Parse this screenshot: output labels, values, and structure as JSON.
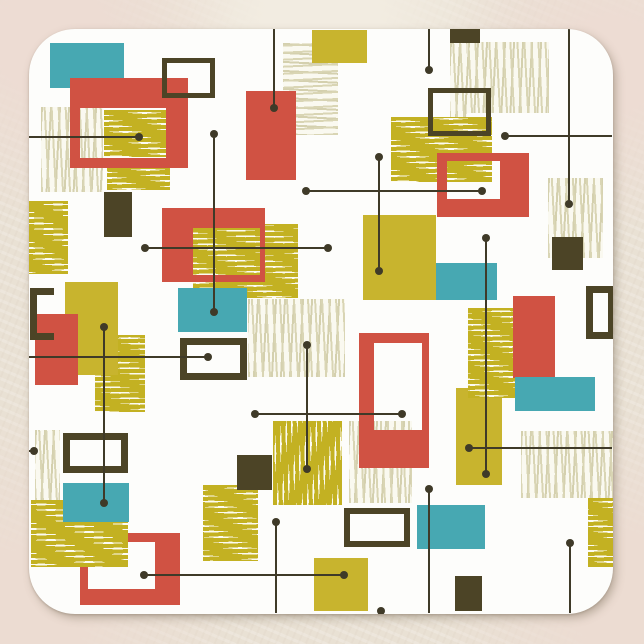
{
  "scene": {
    "description": "mid-century-modern-abstract-rectangles-coaster",
    "canvas": {
      "width": 644,
      "height": 644
    }
  },
  "palette": {
    "red": "#d05243",
    "teal": "#47a8b2",
    "mustard": "#c8b42e",
    "dark": "#4c4426",
    "mustard_line": "#c3b122",
    "pale_line": "#d9d5b4",
    "hatch_bg": "#fcfbf2",
    "line": "#3f3a28",
    "coaster_white": "#fdfdfb",
    "background_beige": "#e9e1d4"
  },
  "coaster": {
    "x": 29,
    "y": 29,
    "w": 584,
    "h": 585,
    "radius": 46
  },
  "shapes": [
    {
      "name": "pale-hatch-upper-left",
      "kind": "hatch",
      "dir": "v",
      "tone": "pale",
      "x": 41,
      "y": 107,
      "w": 62,
      "h": 85
    },
    {
      "name": "mustard-hatch-left",
      "kind": "hatch",
      "dir": "h",
      "tone": "mustard",
      "x": 29,
      "y": 201,
      "w": 39,
      "h": 73
    },
    {
      "name": "mustard-hatch-below-frame1",
      "kind": "hatch",
      "dir": "h",
      "tone": "mustard",
      "x": 107,
      "y": 167,
      "w": 63,
      "h": 23
    },
    {
      "name": "mustard-hatch-left-mid",
      "kind": "hatch",
      "dir": "h",
      "tone": "mustard",
      "x": 95,
      "y": 335,
      "w": 50,
      "h": 77
    },
    {
      "name": "pale-hatch-top-center",
      "kind": "hatch",
      "dir": "h",
      "tone": "pale",
      "x": 283,
      "y": 43,
      "w": 55,
      "h": 92
    },
    {
      "name": "pale-hatch-top-right",
      "kind": "hatch",
      "dir": "v",
      "tone": "pale",
      "x": 450,
      "y": 42,
      "w": 99,
      "h": 71
    },
    {
      "name": "pale-hatch-top-right-column",
      "kind": "hatch",
      "dir": "v",
      "tone": "pale",
      "x": 450,
      "y": 42,
      "w": 17,
      "h": 93
    },
    {
      "name": "mustard-hatch-upper-right",
      "kind": "hatch",
      "dir": "h",
      "tone": "mustard",
      "x": 391,
      "y": 117,
      "w": 101,
      "h": 65
    },
    {
      "name": "pale-hatch-right",
      "kind": "hatch",
      "dir": "v",
      "tone": "pale",
      "x": 548,
      "y": 178,
      "w": 55,
      "h": 80
    },
    {
      "name": "mustard-hatch-under-red-center",
      "kind": "hatch",
      "dir": "h",
      "tone": "mustard",
      "x": 193,
      "y": 224,
      "w": 105,
      "h": 74
    },
    {
      "name": "pale-hatch-center",
      "kind": "hatch",
      "dir": "v",
      "tone": "pale",
      "x": 248,
      "y": 299,
      "w": 97,
      "h": 78
    },
    {
      "name": "pale-hatch-left-edge",
      "kind": "hatch",
      "dir": "v",
      "tone": "pale",
      "x": 35,
      "y": 430,
      "w": 25,
      "h": 73
    },
    {
      "name": "mustard-hatch-center-low",
      "kind": "hatch",
      "dir": "h",
      "tone": "mustard",
      "x": 203,
      "y": 485,
      "w": 55,
      "h": 76
    },
    {
      "name": "mustard-hatch-mid-right",
      "kind": "hatch",
      "dir": "v",
      "tone": "mustard",
      "x": 273,
      "y": 421,
      "w": 69,
      "h": 84
    },
    {
      "name": "pale-hatch-behind-red-frame3",
      "kind": "hatch",
      "dir": "v",
      "tone": "pale",
      "x": 349,
      "y": 421,
      "w": 63,
      "h": 82
    },
    {
      "name": "pale-hatch-bottom-right",
      "kind": "hatch",
      "dir": "v",
      "tone": "pale",
      "x": 521,
      "y": 431,
      "w": 92,
      "h": 67
    },
    {
      "name": "mustard-hatch-right-edge",
      "kind": "hatch",
      "dir": "h",
      "tone": "mustard",
      "x": 588,
      "y": 498,
      "w": 25,
      "h": 69
    },
    {
      "name": "teal-rect-top-left",
      "kind": "solid",
      "color": "teal",
      "x": 50,
      "y": 43,
      "w": 74,
      "h": 45
    },
    {
      "name": "mustard-rect-top",
      "kind": "solid",
      "color": "mustard",
      "x": 312,
      "y": 30,
      "w": 55,
      "h": 33
    },
    {
      "name": "dark-rect-top",
      "kind": "solid",
      "color": "dark",
      "x": 450,
      "y": 29,
      "w": 30,
      "h": 14
    },
    {
      "name": "red-rect-upper-right",
      "kind": "solid",
      "color": "red",
      "x": 246,
      "y": 91,
      "w": 50,
      "h": 89
    },
    {
      "name": "red-frame-top-left",
      "kind": "frame",
      "color": "red",
      "x": 70,
      "y": 78,
      "w": 118,
      "h": 90,
      "bw": [
        30,
        22,
        10,
        10
      ]
    },
    {
      "name": "mustard-hatch-in-frame1",
      "kind": "hatch",
      "dir": "h",
      "tone": "mustard",
      "x": 104,
      "y": 110,
      "w": 62,
      "h": 47
    },
    {
      "name": "dark-outline-square-top-left",
      "kind": "frame",
      "color": "dark",
      "x": 162,
      "y": 58,
      "w": 53,
      "h": 40,
      "bw": [
        5,
        5,
        5,
        5
      ]
    },
    {
      "name": "dark-rect-mid-left",
      "kind": "solid",
      "color": "dark",
      "x": 104,
      "y": 192,
      "w": 28,
      "h": 45
    },
    {
      "name": "red-rect-center",
      "kind": "solid",
      "color": "red",
      "x": 162,
      "y": 208,
      "w": 103,
      "h": 74
    },
    {
      "name": "mustard-hatch-in-red-center",
      "kind": "hatch",
      "dir": "h",
      "tone": "mustard",
      "x": 193,
      "y": 228,
      "w": 67,
      "h": 47
    },
    {
      "name": "teal-rect-center",
      "kind": "solid",
      "color": "teal",
      "x": 178,
      "y": 288,
      "w": 69,
      "h": 44
    },
    {
      "name": "mustard-rect-left",
      "kind": "solid",
      "color": "mustard",
      "x": 65,
      "y": 282,
      "w": 53,
      "h": 93
    },
    {
      "name": "red-rect-left",
      "kind": "solid",
      "color": "red",
      "x": 35,
      "y": 314,
      "w": 43,
      "h": 71
    },
    {
      "name": "dark-bracket-left",
      "kind": "bracket",
      "color": "dark",
      "x": 30,
      "y": 288,
      "w": 24,
      "h": 52,
      "stroke": 7
    },
    {
      "name": "dark-outline-square-upper-mid",
      "kind": "frame",
      "color": "dark",
      "x": 428,
      "y": 88,
      "w": 63,
      "h": 48,
      "bw": [
        5,
        5,
        5,
        5
      ]
    },
    {
      "name": "red-frame-upper-right",
      "kind": "frame",
      "color": "red",
      "x": 437,
      "y": 153,
      "w": 92,
      "h": 64,
      "bw": [
        8,
        29,
        18,
        10
      ]
    },
    {
      "name": "mustard-square-mid",
      "kind": "solid",
      "color": "mustard",
      "x": 363,
      "y": 215,
      "w": 73,
      "h": 85
    },
    {
      "name": "teal-rect-mid",
      "kind": "solid",
      "color": "teal",
      "x": 436,
      "y": 263,
      "w": 61,
      "h": 37
    },
    {
      "name": "dark-rect-right",
      "kind": "solid",
      "color": "dark",
      "x": 552,
      "y": 237,
      "w": 31,
      "h": 33
    },
    {
      "name": "dark-outline-right-edge",
      "kind": "frame",
      "color": "dark",
      "x": 586,
      "y": 286,
      "w": 29,
      "h": 53,
      "bw": [
        7,
        7,
        7,
        7
      ]
    },
    {
      "name": "mustard-rect-tall",
      "kind": "solid",
      "color": "mustard",
      "x": 456,
      "y": 388,
      "w": 46,
      "h": 97
    },
    {
      "name": "mustard-hatch-over-tall",
      "kind": "hatch",
      "dir": "h",
      "tone": "mustard",
      "x": 468,
      "y": 308,
      "w": 47,
      "h": 90
    },
    {
      "name": "red-rect-right",
      "kind": "solid",
      "color": "red",
      "x": 513,
      "y": 296,
      "w": 42,
      "h": 82
    },
    {
      "name": "teal-rect-right",
      "kind": "solid",
      "color": "teal",
      "x": 515,
      "y": 377,
      "w": 80,
      "h": 34
    },
    {
      "name": "red-frame-tall-center",
      "kind": "frame",
      "color": "red",
      "x": 359,
      "y": 333,
      "w": 70,
      "h": 135,
      "bw": [
        10,
        7,
        38,
        15
      ]
    },
    {
      "name": "dark-square-center",
      "kind": "solid",
      "color": "dark",
      "x": 237,
      "y": 455,
      "w": 35,
      "h": 35
    },
    {
      "name": "teal-rect-lower-mid",
      "kind": "solid",
      "color": "teal",
      "x": 417,
      "y": 505,
      "w": 68,
      "h": 44
    },
    {
      "name": "dark-outline-lower-mid",
      "kind": "frame",
      "color": "dark",
      "x": 344,
      "y": 508,
      "w": 66,
      "h": 39,
      "bw": [
        6,
        6,
        6,
        6
      ]
    },
    {
      "name": "dark-rect-bottom",
      "kind": "solid",
      "color": "dark",
      "x": 455,
      "y": 576,
      "w": 27,
      "h": 35
    },
    {
      "name": "mustard-rect-bottom",
      "kind": "solid",
      "color": "mustard",
      "x": 314,
      "y": 558,
      "w": 54,
      "h": 53
    },
    {
      "name": "dark-outline-mid-left",
      "kind": "frame",
      "color": "dark",
      "x": 63,
      "y": 433,
      "w": 65,
      "h": 40,
      "bw": [
        7,
        7,
        7,
        7
      ]
    },
    {
      "name": "dark-outline-center-left",
      "kind": "frame",
      "color": "dark",
      "x": 180,
      "y": 338,
      "w": 67,
      "h": 42,
      "bw": [
        7,
        7,
        7,
        7
      ]
    },
    {
      "name": "red-frame-bottom-left",
      "kind": "frame",
      "color": "red",
      "x": 80,
      "y": 533,
      "w": 100,
      "h": 72,
      "bw": [
        9,
        25,
        16,
        8
      ]
    },
    {
      "name": "mustard-hatch-over-frame4",
      "kind": "hatch",
      "dir": "h",
      "tone": "mustard",
      "x": 31,
      "y": 500,
      "w": 97,
      "h": 67
    },
    {
      "name": "teal-rect-lower-left",
      "kind": "solid",
      "color": "teal",
      "x": 63,
      "y": 483,
      "w": 66,
      "h": 39
    }
  ],
  "lines": [
    {
      "name": "line-h-upper-left",
      "o": "h",
      "x": 29,
      "y": 137,
      "len": 110,
      "ds": false,
      "de": true
    },
    {
      "name": "line-v-left-tall",
      "o": "v",
      "x": 214,
      "y": 134,
      "len": 178,
      "ds": true,
      "de": true
    },
    {
      "name": "line-v-top-a",
      "o": "v",
      "x": 274,
      "y": 29,
      "len": 79,
      "ds": false,
      "de": true
    },
    {
      "name": "line-v-top-b",
      "o": "v",
      "x": 429,
      "y": 29,
      "len": 41,
      "ds": false,
      "de": true
    },
    {
      "name": "line-v-top-c",
      "o": "v",
      "x": 569,
      "y": 29,
      "len": 175,
      "ds": false,
      "de": true
    },
    {
      "name": "line-h-upper-right",
      "o": "h",
      "x": 505,
      "y": 136,
      "len": 107,
      "ds": true,
      "de": false
    },
    {
      "name": "line-h-mid-a",
      "o": "h",
      "x": 306,
      "y": 191,
      "len": 176,
      "ds": true,
      "de": true
    },
    {
      "name": "line-h-mid-b",
      "o": "h",
      "x": 145,
      "y": 248,
      "len": 183,
      "ds": true,
      "de": true
    },
    {
      "name": "line-v-mid-a",
      "o": "v",
      "x": 379,
      "y": 157,
      "len": 114,
      "ds": true,
      "de": true
    },
    {
      "name": "line-v-mid-b",
      "o": "v",
      "x": 486,
      "y": 238,
      "len": 236,
      "ds": true,
      "de": true
    },
    {
      "name": "line-h-right-low",
      "o": "h",
      "x": 469,
      "y": 448,
      "len": 143,
      "ds": true,
      "de": false
    },
    {
      "name": "line-h-left-mid",
      "o": "h",
      "x": 29,
      "y": 357,
      "len": 179,
      "ds": false,
      "de": true
    },
    {
      "name": "line-v-center",
      "o": "v",
      "x": 307,
      "y": 345,
      "len": 124,
      "ds": true,
      "de": true
    },
    {
      "name": "line-h-center-low",
      "o": "h",
      "x": 255,
      "y": 414,
      "len": 147,
      "ds": true,
      "de": true
    },
    {
      "name": "line-v-left-low",
      "o": "v",
      "x": 104,
      "y": 327,
      "len": 176,
      "ds": true,
      "de": true
    },
    {
      "name": "line-h-bottom",
      "o": "h",
      "x": 144,
      "y": 575,
      "len": 200,
      "ds": true,
      "de": true
    },
    {
      "name": "line-v-bottom-a",
      "o": "v",
      "x": 276,
      "y": 522,
      "len": 91,
      "ds": true,
      "de": false
    },
    {
      "name": "line-v-bottom-b",
      "o": "v",
      "x": 429,
      "y": 489,
      "len": 124,
      "ds": true,
      "de": false
    },
    {
      "name": "line-v-bottom-c",
      "o": "v",
      "x": 570,
      "y": 543,
      "len": 70,
      "ds": true,
      "de": false
    },
    {
      "name": "line-h-left-stub",
      "o": "h",
      "x": 29,
      "y": 451,
      "len": 5,
      "ds": false,
      "de": true
    }
  ],
  "dots": [
    {
      "name": "dot-bottom-edge",
      "x": 381,
      "y": 611
    }
  ]
}
